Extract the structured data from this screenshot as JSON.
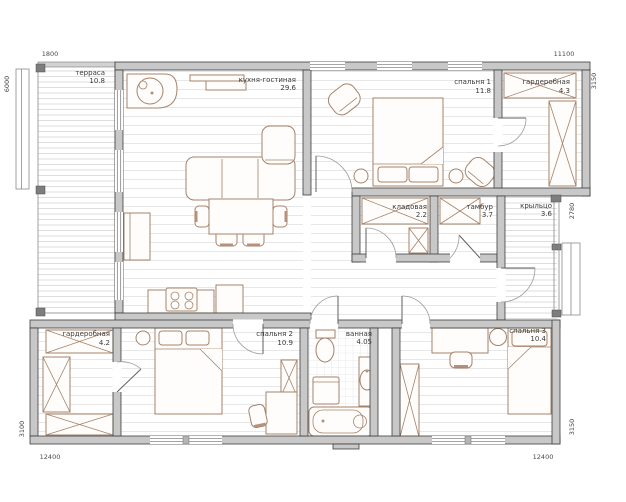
{
  "plan_type": "floor-plan",
  "rooms": [
    {
      "id": "terrace",
      "name": "терраса",
      "area": "10.8"
    },
    {
      "id": "kitchen-living",
      "name": "кухня-гостиная",
      "area": "29.6"
    },
    {
      "id": "bedroom-1",
      "name": "спальня 1",
      "area": "11.8"
    },
    {
      "id": "wardrobe-1",
      "name": "гардеробная",
      "area": "4.3"
    },
    {
      "id": "storage",
      "name": "кладовая",
      "area": "2.2"
    },
    {
      "id": "vestibule",
      "name": "тамбур",
      "area": "3.7"
    },
    {
      "id": "porch",
      "name": "крыльцо",
      "area": "3.6"
    },
    {
      "id": "wardrobe-2",
      "name": "гардеробная",
      "area": "4.2"
    },
    {
      "id": "bedroom-2",
      "name": "спальня 2",
      "area": "10.9"
    },
    {
      "id": "bathroom",
      "name": "ванная",
      "area": "4.05"
    },
    {
      "id": "bedroom-3",
      "name": "спальня 3",
      "area": "10.4"
    }
  ],
  "dimensions_mm": {
    "top_left": "1800",
    "top_right": "11100",
    "left_upper": "6000",
    "left_lower": "3100",
    "right_upper": "3150",
    "right_middle": "2780",
    "right_lower": "3150",
    "bottom_left": "12400",
    "bottom_right": "12400"
  },
  "colors": {
    "wall_fill": "#c8c8c8",
    "wall_outline": "#3e3e3e",
    "furniture": "#a5826a",
    "label_text": "#3a3a3a",
    "floor_line": "#e7e7e7"
  }
}
